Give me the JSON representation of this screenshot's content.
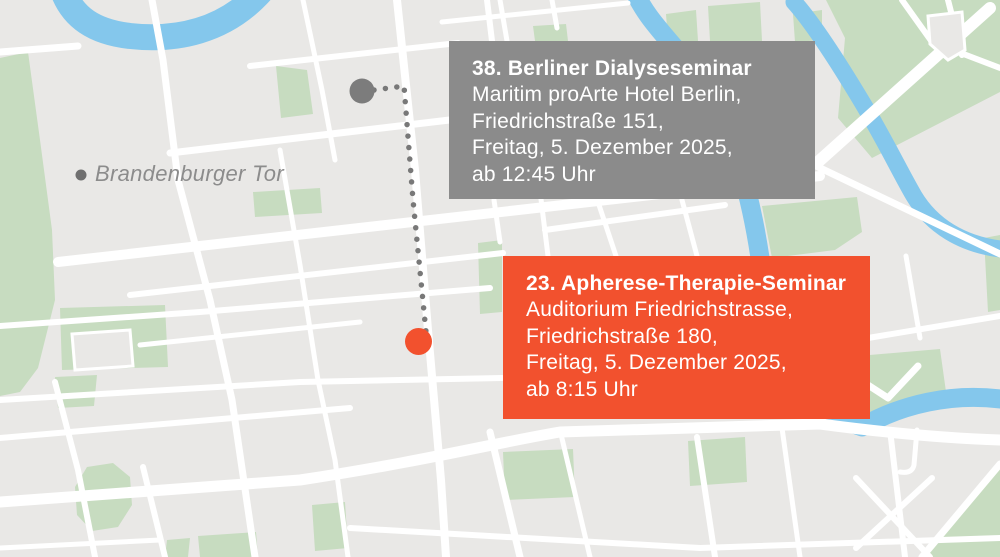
{
  "map": {
    "poi_label": "Brandenburger Tor",
    "colors": {
      "background": "#e9e8e6",
      "street": "#ffffff",
      "park": "#c7dcc0",
      "water": "#84c7ec",
      "poi_dot": "#6f6f6f",
      "connector_dots": "#787878"
    }
  },
  "events": [
    {
      "title": "38. Berliner Dialyseseminar",
      "lines": [
        "Maritim proArte Hotel Berlin,",
        "Friedrichstraße 151,",
        "Freitag, 5. Dezember 2025,",
        "ab 12:45 Uhr"
      ],
      "box_color": "#8b8b8b",
      "marker_color": "#7c7c7c"
    },
    {
      "title": "23. Apherese-Therapie-Seminar",
      "lines": [
        "Auditorium Friedrichstrasse,",
        "Friedrichstraße 180,",
        "Freitag, 5. Dezember 2025,",
        "ab 8:15 Uhr"
      ],
      "box_color": "#f2512e",
      "marker_color": "#f2512e"
    }
  ]
}
